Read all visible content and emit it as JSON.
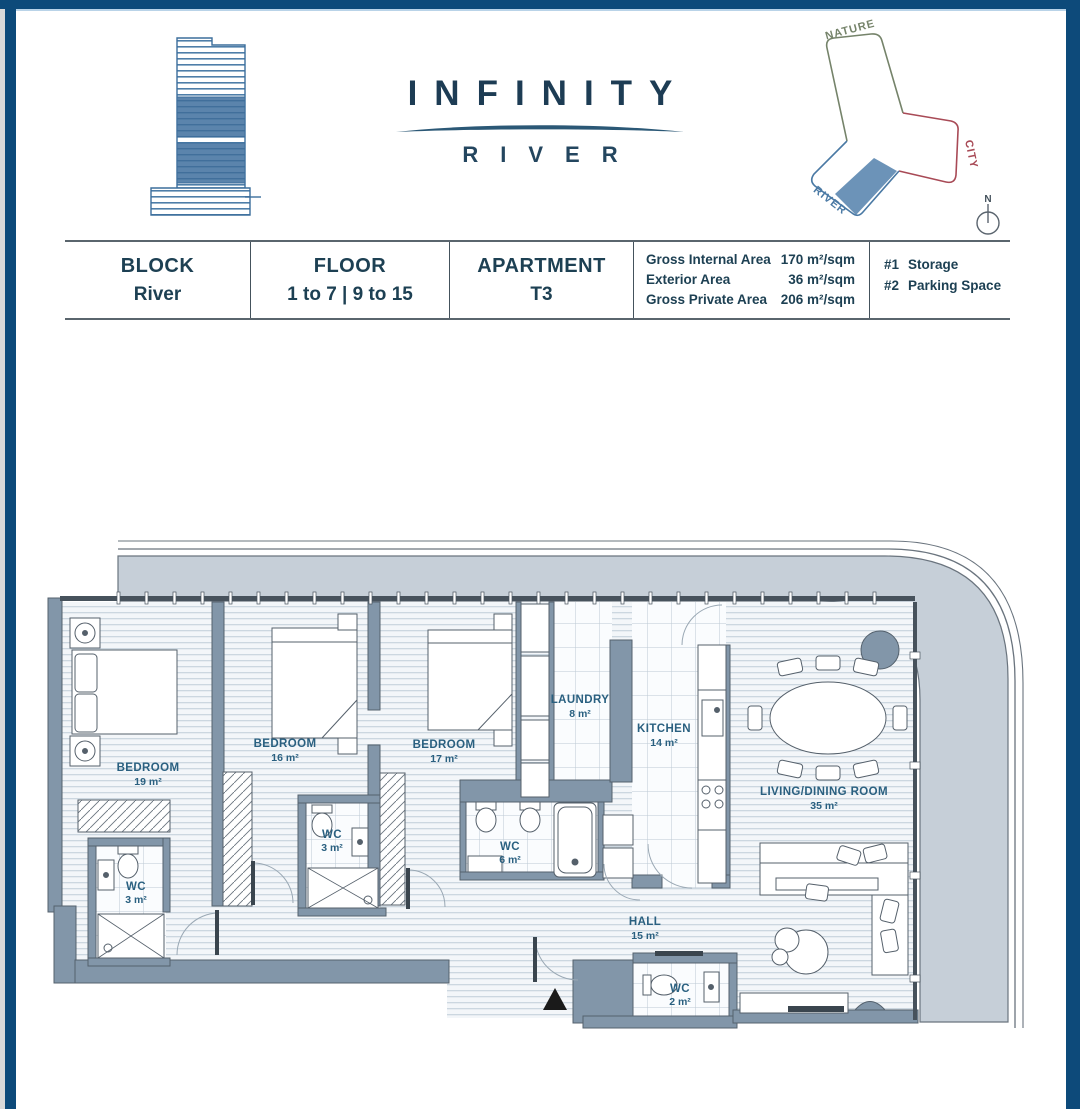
{
  "header": {
    "brand_title": "INFINITY",
    "brand_subtitle": "RIVER"
  },
  "orientation": {
    "nature_label": "NATURE",
    "city_label": "CITY",
    "river_label": "RIVER",
    "compass_label": "N",
    "colors": {
      "nature": "#75836a",
      "city": "#a84a56",
      "river": "#4a79a4",
      "highlight": "#6c93b8"
    }
  },
  "info_table": {
    "columns": [
      {
        "label": "BLOCK",
        "value": "River"
      },
      {
        "label": "FLOOR",
        "value": "1 to 7 | 9 to 15"
      },
      {
        "label": "APARTMENT",
        "value": "T3"
      }
    ],
    "areas": [
      {
        "label": "Gross Internal Area",
        "value": "170 m²/sqm"
      },
      {
        "label": "Exterior Area",
        "value": "36 m²/sqm"
      },
      {
        "label": "Gross Private Area",
        "value": "206 m²/sqm"
      }
    ],
    "extras": [
      {
        "num": "#1",
        "label": "Storage"
      },
      {
        "num": "#2",
        "label": "Parking Space"
      }
    ]
  },
  "floor_plan": {
    "rooms": [
      {
        "name": "BEDROOM",
        "area": "19 m²"
      },
      {
        "name": "BEDROOM",
        "area": "16 m²"
      },
      {
        "name": "BEDROOM",
        "area": "17 m²"
      },
      {
        "name": "LAUNDRY",
        "area": "8 m²"
      },
      {
        "name": "KITCHEN",
        "area": "14 m²"
      },
      {
        "name": "LIVING/DINING ROOM",
        "area": "35 m²"
      },
      {
        "name": "WC",
        "area": "3 m²"
      },
      {
        "name": "WC",
        "area": "3 m²"
      },
      {
        "name": "WC",
        "area": "6 m²"
      },
      {
        "name": "HALL",
        "area": "15 m²"
      },
      {
        "name": "WC",
        "area": "2 m²"
      }
    ],
    "colors": {
      "wall": "#8296a9",
      "terrace": "#c6cfd8",
      "label": "#2a6080",
      "border": "#0d4a7a"
    }
  }
}
